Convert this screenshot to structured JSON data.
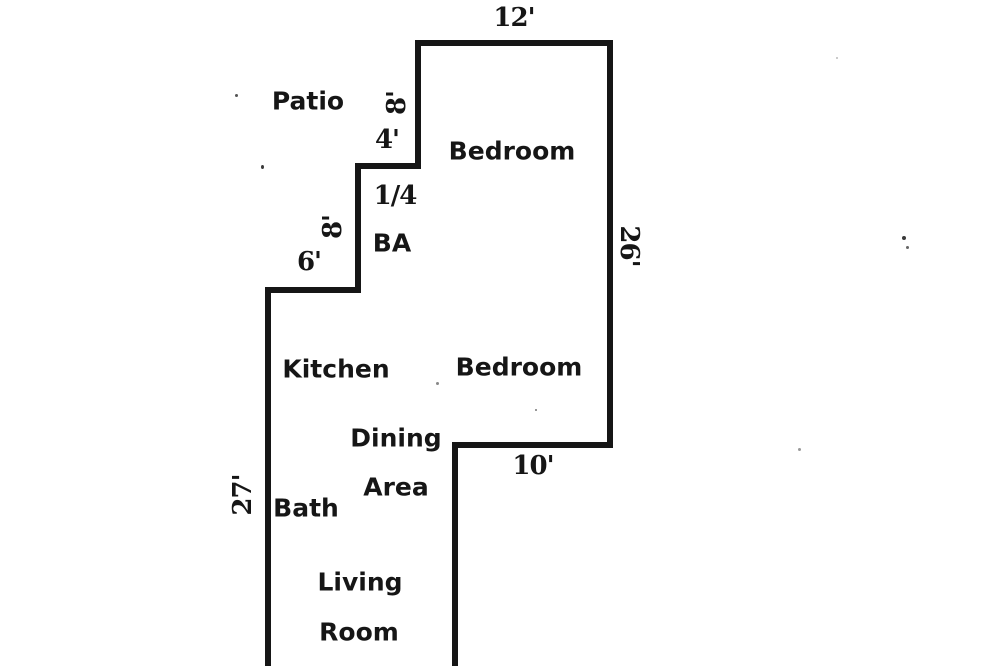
{
  "document": {
    "type": "floor-plan",
    "colors": {
      "wall": "#161616",
      "text": "#161616",
      "background": "#ffffff"
    }
  },
  "rooms": {
    "patio": "Patio",
    "bedroom_top": "Bedroom",
    "quarter_bath": {
      "line1": "1/4",
      "line2": "BA"
    },
    "kitchen": "Kitchen",
    "bedroom_middle": "Bedroom",
    "dining": {
      "line1": "Dining",
      "line2": "Area"
    },
    "bath": "Bath",
    "living": {
      "line1": "Living",
      "line2": "Room"
    }
  },
  "dimensions": {
    "top_bedroom_width": "12'",
    "patio_wall_height": "8'",
    "step_width": "4'",
    "ba_wall_height": "8'",
    "kitchen_step_width": "6'",
    "right_wall_height": "26'",
    "middle_bedroom_width": "10'",
    "left_wall_height": "27'"
  }
}
